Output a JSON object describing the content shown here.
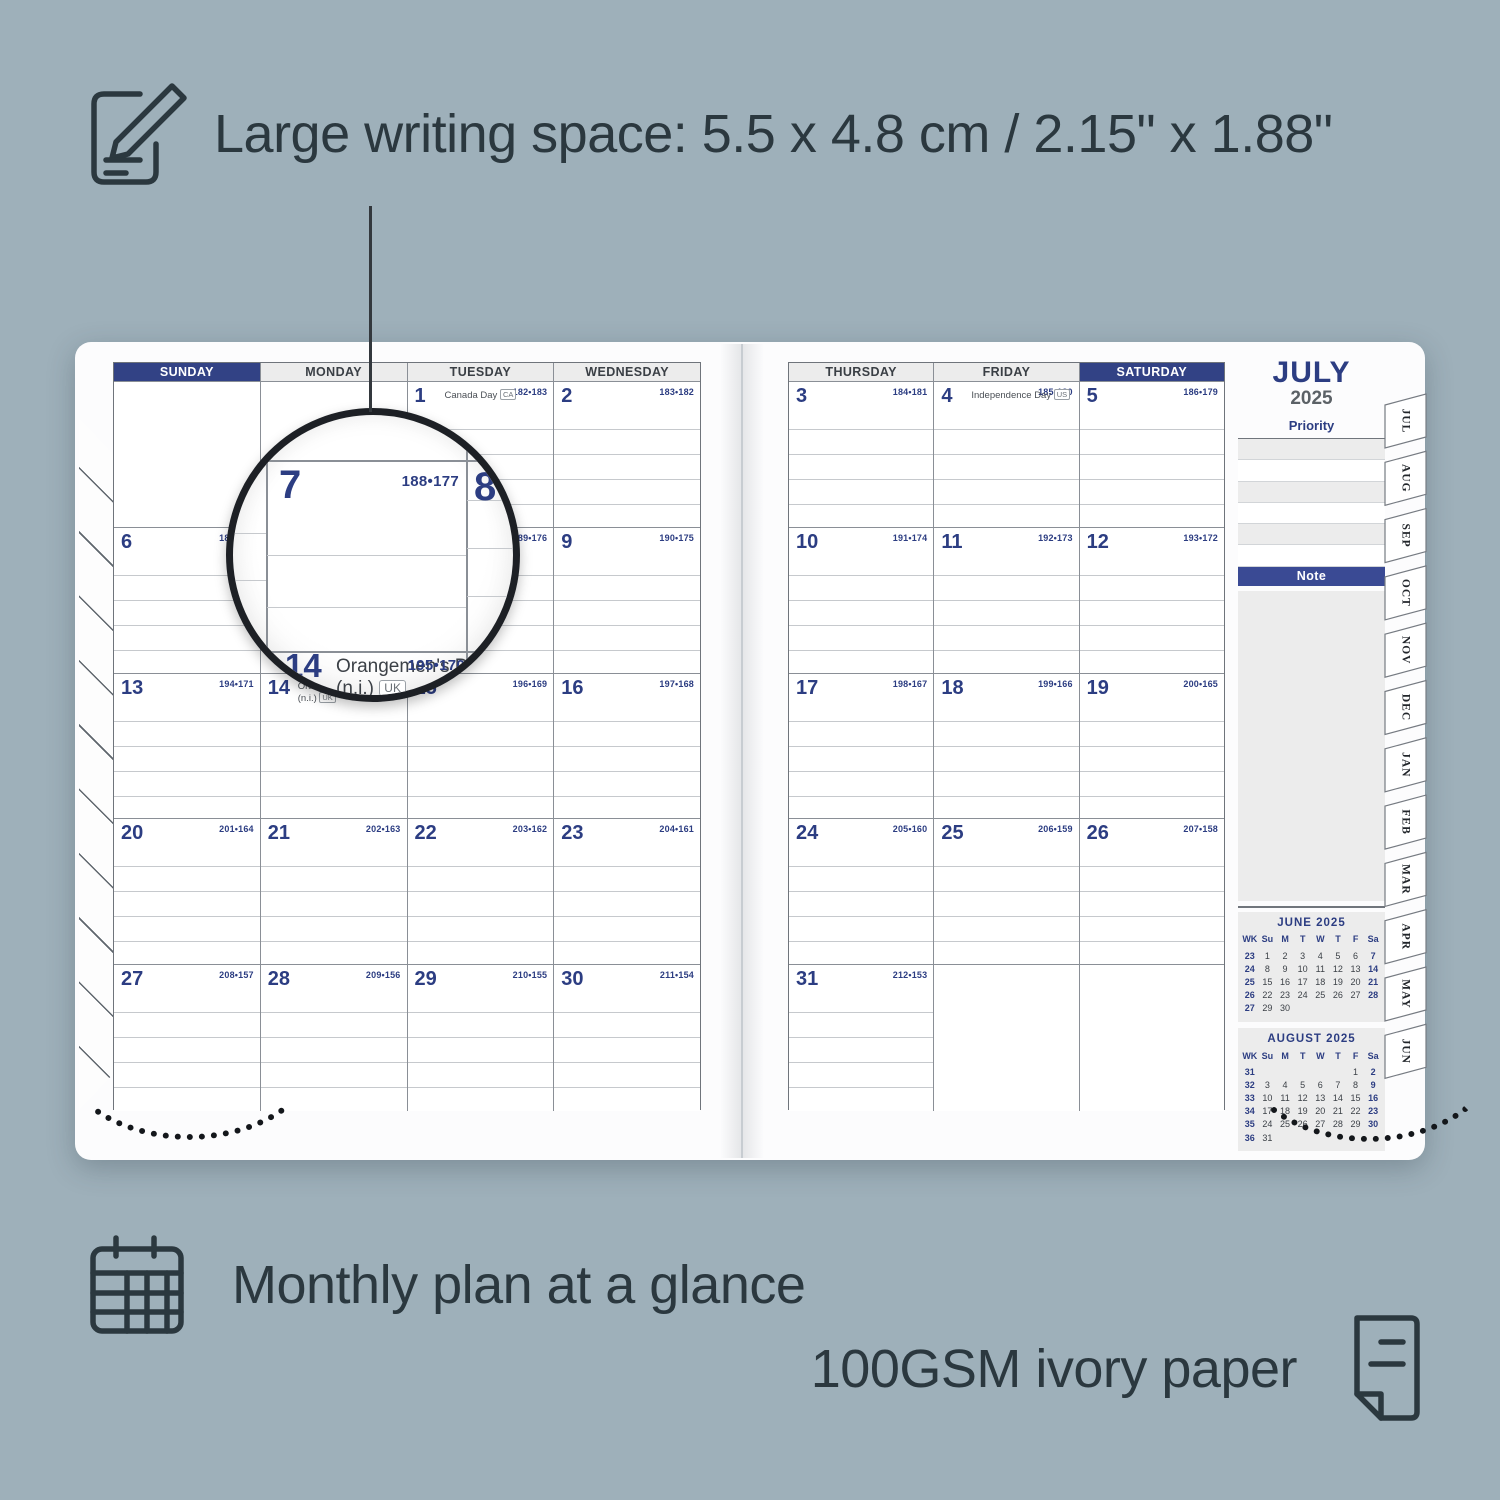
{
  "colors": {
    "background": "#9EB0BA",
    "navy": "#2C3D82",
    "header_highlight": "#324285",
    "note_bar": "#3A4A94",
    "text_dark": "#2B383F",
    "panel_gray": "#ECECEC"
  },
  "icons": {
    "top": "notepad-pencil-icon",
    "bottom_left": "calendar-grid-icon",
    "bottom_right": "paper-sheet-icon"
  },
  "annotations": {
    "top": "Large writing space: 5.5 x 4.8 cm / 2.15\" x 1.88\"",
    "bottom_left": "Monthly plan at a glance",
    "bottom_right": "100GSM ivory paper"
  },
  "planner": {
    "month": "JULY",
    "year": "2025",
    "priority_label": "Priority",
    "note_label": "Note",
    "weekdays_left": [
      "SUNDAY",
      "MONDAY",
      "TUESDAY",
      "WEDNESDAY"
    ],
    "weekdays_right": [
      "THURSDAY",
      "FRIDAY",
      "SATURDAY"
    ],
    "left_weeks": [
      [
        {
          "blank": true
        },
        {
          "blank": true
        },
        {
          "day": "1",
          "holiday": "Canada Day",
          "badge": "CA",
          "doy": "182•183"
        },
        {
          "day": "2",
          "doy": "183•182"
        }
      ],
      [
        {
          "day": "6",
          "doy": "187•178"
        },
        {
          "day": "7",
          "doy": "188•177"
        },
        {
          "day": "8",
          "doy": "189•176"
        },
        {
          "day": "9",
          "doy": "190•175"
        }
      ],
      [
        {
          "day": "13",
          "doy": "194•171"
        },
        {
          "day": "14",
          "holiday": "Orangemen's Day",
          "holiday2": "(n.i.)",
          "badge": "UK",
          "doy": "195•170"
        },
        {
          "day": "15",
          "doy": "196•169"
        },
        {
          "day": "16",
          "doy": "197•168"
        }
      ],
      [
        {
          "day": "20",
          "doy": "201•164"
        },
        {
          "day": "21",
          "doy": "202•163"
        },
        {
          "day": "22",
          "doy": "203•162"
        },
        {
          "day": "23",
          "doy": "204•161"
        }
      ],
      [
        {
          "day": "27",
          "doy": "208•157"
        },
        {
          "day": "28",
          "doy": "209•156"
        },
        {
          "day": "29",
          "doy": "210•155"
        },
        {
          "day": "30",
          "doy": "211•154"
        }
      ]
    ],
    "right_weeks": [
      [
        {
          "day": "3",
          "doy": "184•181"
        },
        {
          "day": "4",
          "holiday": "Independence Day",
          "badge": "US",
          "doy": "185•180"
        },
        {
          "day": "5",
          "doy": "186•179"
        }
      ],
      [
        {
          "day": "10",
          "doy": "191•174"
        },
        {
          "day": "11",
          "doy": "192•173"
        },
        {
          "day": "12",
          "doy": "193•172"
        }
      ],
      [
        {
          "day": "17",
          "doy": "198•167"
        },
        {
          "day": "18",
          "doy": "199•166"
        },
        {
          "day": "19",
          "doy": "200•165"
        }
      ],
      [
        {
          "day": "24",
          "doy": "205•160"
        },
        {
          "day": "25",
          "doy": "206•159"
        },
        {
          "day": "26",
          "doy": "207•158"
        }
      ],
      [
        {
          "day": "31",
          "doy": "212•153"
        },
        {
          "blank": true
        },
        {
          "blank": true
        }
      ]
    ],
    "tabs": [
      "JUL",
      "AUG",
      "SEP",
      "OCT",
      "NOV",
      "DEC",
      "JAN",
      "FEB",
      "MAR",
      "APR",
      "MAY",
      "JUN"
    ],
    "mini_calendars": [
      {
        "title": "JUNE 2025",
        "header": [
          "WK",
          "Su",
          "M",
          "T",
          "W",
          "T",
          "F",
          "Sa"
        ],
        "rows": [
          [
            "23",
            "1",
            "2",
            "3",
            "4",
            "5",
            "6",
            "7"
          ],
          [
            "24",
            "8",
            "9",
            "10",
            "11",
            "12",
            "13",
            "14"
          ],
          [
            "25",
            "15",
            "16",
            "17",
            "18",
            "19",
            "20",
            "21"
          ],
          [
            "26",
            "22",
            "23",
            "24",
            "25",
            "26",
            "27",
            "28"
          ],
          [
            "27",
            "29",
            "30",
            "",
            "",
            "",
            "",
            ""
          ]
        ]
      },
      {
        "title": "AUGUST 2025",
        "header": [
          "WK",
          "Su",
          "M",
          "T",
          "W",
          "T",
          "F",
          "Sa"
        ],
        "rows": [
          [
            "31",
            "",
            "",
            "",
            "",
            "",
            "1",
            "2"
          ],
          [
            "32",
            "3",
            "4",
            "5",
            "6",
            "7",
            "8",
            "9"
          ],
          [
            "33",
            "10",
            "11",
            "12",
            "13",
            "14",
            "15",
            "16"
          ],
          [
            "34",
            "17",
            "18",
            "19",
            "20",
            "21",
            "22",
            "23"
          ],
          [
            "35",
            "24",
            "25",
            "26",
            "27",
            "28",
            "29",
            "30"
          ],
          [
            "36",
            "31",
            "",
            "",
            "",
            "",
            "",
            ""
          ]
        ]
      }
    ],
    "magnifier": {
      "fragment_doy": "78",
      "day_7": "7",
      "doy_7": "188•177",
      "day_8": "8",
      "day_14": "14",
      "holiday": "Orangemen's Day",
      "holiday_ni": "(n.i.)",
      "badge": "UK",
      "doy_14": "195•170"
    }
  }
}
